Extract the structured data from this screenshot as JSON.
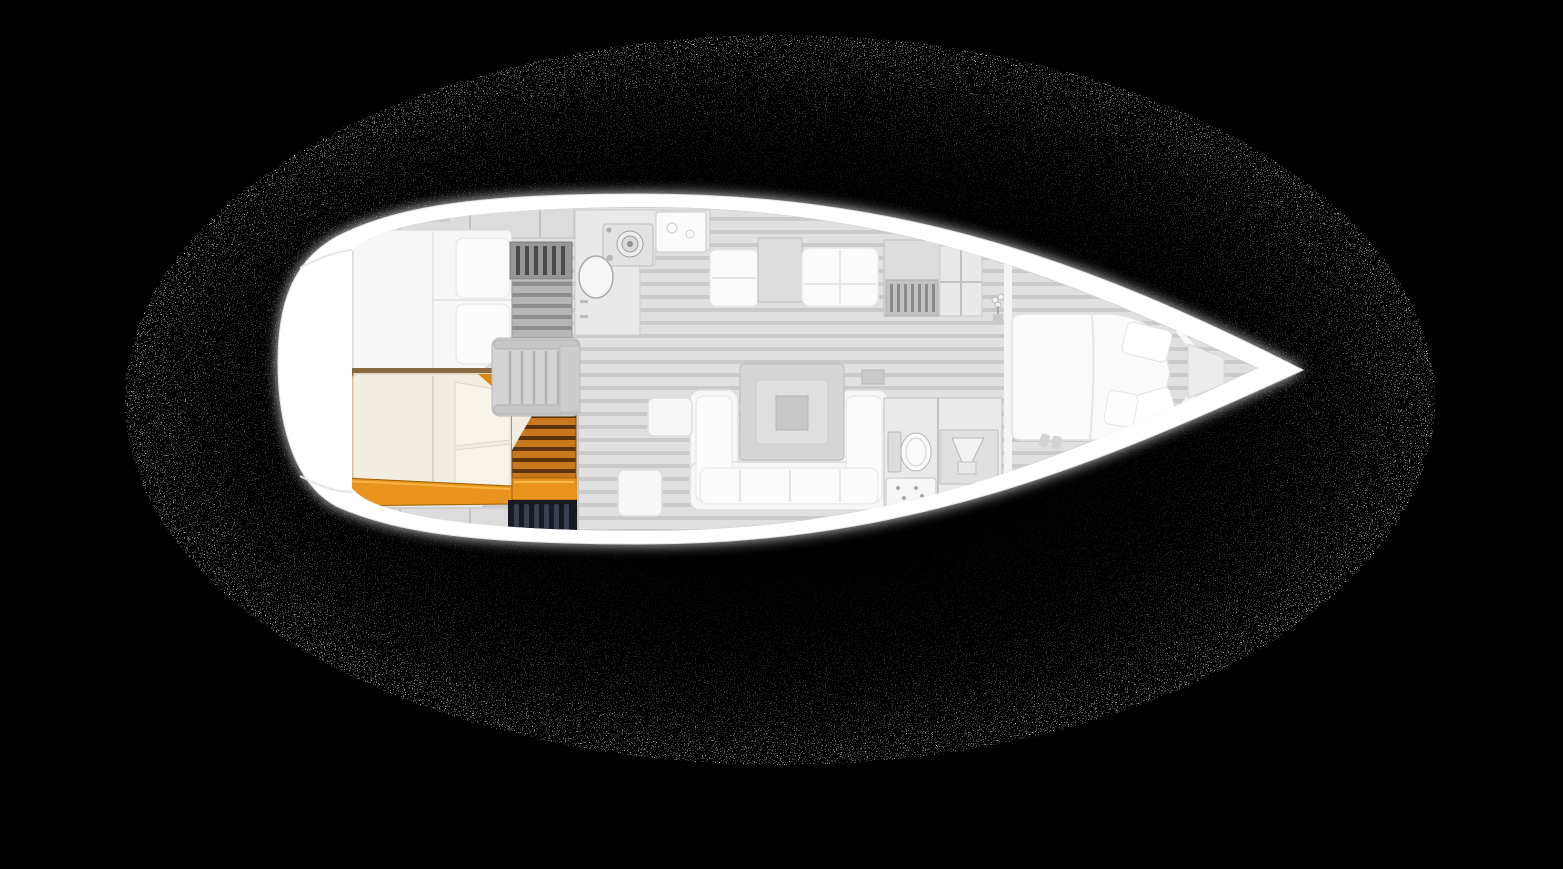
{
  "scene": {
    "kind": "yacht-interior-floor-plan-top-view",
    "orientation": "bow-right-stern-left",
    "visible_text": "none"
  },
  "palette": {
    "background": "#000000",
    "noise_dot": "#ffffff",
    "hull": "#ffffff",
    "hull_edge": "#e3e3e3",
    "deck_band": "#d7d7d7",
    "interior_base": "#e6e6e6",
    "floor_stripe_light": "#e0e0e0",
    "floor_stripe_dark": "#cacaca",
    "greyed_furniture": "#f7f7f7",
    "highlight_wood": "#e8931d",
    "highlight_wood_dark": "#9d6206",
    "highlight_plank": "#c9771b",
    "highlight_plank_gap": "#5a3408",
    "highlight_headboard": "#c98a33",
    "highlight_mattress": "#f2ede1",
    "locker_dark": "#171a21",
    "locker_slat": "#39404e"
  },
  "regions": [
    {
      "id": "stern-platform",
      "label": "Stern platform",
      "status": "greyed"
    },
    {
      "id": "port-aft-cabin",
      "label": "Port aft double cabin",
      "status": "greyed"
    },
    {
      "id": "starboard-aft-cabin",
      "label": "Starboard aft double cabin",
      "status": "highlighted"
    },
    {
      "id": "companionway",
      "label": "Companionway steps",
      "status": "greyed"
    },
    {
      "id": "galley",
      "label": "Galley with stove and sink",
      "status": "greyed"
    },
    {
      "id": "saloon",
      "label": "Saloon with U-sofa and table",
      "status": "greyed"
    },
    {
      "id": "nav-cabinets",
      "label": "Cabinets / navigation area",
      "status": "greyed"
    },
    {
      "id": "head",
      "label": "Head with toilet and shower",
      "status": "greyed"
    },
    {
      "id": "v-berth",
      "label": "Forward V-berth cabin",
      "status": "greyed"
    },
    {
      "id": "bow-locker",
      "label": "Bow anchor locker",
      "status": "greyed"
    }
  ],
  "selection": {
    "selected_region": "starboard-aft-cabin"
  }
}
